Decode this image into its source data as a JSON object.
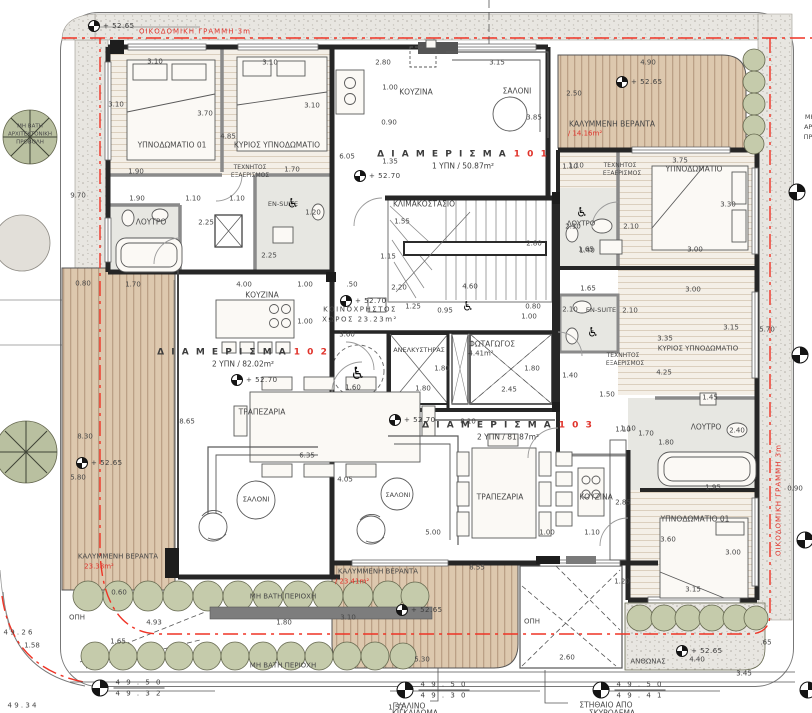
{
  "plan": {
    "colors": {
      "accent_red": "#e0322a",
      "wall": "#262626",
      "deck_wood": "#ddc8ae",
      "bush_green": "#c5cbab",
      "pavement": "#e8e6e1"
    },
    "apartments": [
      {
        "title": "Δ Ι Α Μ Ε Ρ Ι Σ Μ Α",
        "number": "1 0 1",
        "info": "1 ΥΠΝ / 50.87m²",
        "x": 463,
        "y": 160
      },
      {
        "title": "Δ Ι Α Μ Ε Ρ Ι Σ Μ Α",
        "number": "1 0 2",
        "info": "2 ΥΠΝ / 82.02m²",
        "x": 243,
        "y": 358
      },
      {
        "title": "Δ Ι Α Μ Ε Ρ Ι Σ Μ Α",
        "number": "1 0 3",
        "info": "2 ΥΠΝ / 81.87m²",
        "x": 508,
        "y": 431
      }
    ],
    "levels": [
      {
        "t": "+ 52.65",
        "x": 100,
        "y": 26
      },
      {
        "t": "+ 52.70",
        "x": 366,
        "y": 176
      },
      {
        "t": "+ 52.65",
        "x": 628,
        "y": 82
      },
      {
        "t": "+ 52.70",
        "x": 243,
        "y": 380
      },
      {
        "t": "+ 52.70",
        "x": 352,
        "y": 301
      },
      {
        "t": "+ 52.65",
        "x": 88,
        "y": 463
      },
      {
        "t": "+ 52.70",
        "x": 401,
        "y": 420
      },
      {
        "t": "+ 52.65",
        "x": 408,
        "y": 610
      },
      {
        "t": "+ 52.65",
        "x": 688,
        "y": 651
      }
    ],
    "spot_elevations": [
      {
        "top": "4 9 . 5 0",
        "bottom": "4 9 . 3 0",
        "x": 433,
        "y": 690
      },
      {
        "top": "4 9 . 5 0",
        "bottom": "4 9 . 4 1",
        "x": 629,
        "y": 690
      },
      {
        "top": "4 9 . 5 0",
        "bottom": "4 9 . 3 2",
        "x": 128,
        "y": 688
      },
      {
        "top": "",
        "bottom": "",
        "x": 797,
        "y": 192
      },
      {
        "top": "",
        "bottom": "",
        "x": 800,
        "y": 355
      },
      {
        "top": "",
        "bottom": "",
        "x": 805,
        "y": 540
      },
      {
        "top": "",
        "bottom": "",
        "x": 808,
        "y": 690
      }
    ],
    "symbols": {
      "wheelchair_glyph": "♿",
      "wheelchair_positions": [
        {
          "x": 293,
          "y": 204
        },
        {
          "x": 582,
          "y": 213
        },
        {
          "x": 468,
          "y": 307
        },
        {
          "x": 358,
          "y": 374,
          "s": 17
        },
        {
          "x": 593,
          "y": 333
        }
      ]
    },
    "labels": [
      {
        "t": "ΥΠΝΟΔΩΜΑΤΙΟ 01",
        "x": 172,
        "y": 145,
        "s": 7.5,
        "n": "room-label-bedroom01"
      },
      {
        "t": "ΚΥΡΙΟΣ ΥΠΝΟΔΩΜΑΤΙΟ",
        "x": 277,
        "y": 145,
        "s": 7.5,
        "n": "room-label-master-bedroom"
      },
      {
        "t": "ΛΟΥΤΡΟ",
        "x": 151,
        "y": 222,
        "s": 7.5,
        "n": "room-label-bathroom"
      },
      {
        "t": "EN-SUITE",
        "x": 283,
        "y": 204,
        "s": 6.5,
        "n": "room-label-ensuite"
      },
      {
        "t": "ΤΕΧΝΗΤΟΣ",
        "x": 250,
        "y": 168,
        "s": 6
      },
      {
        "t": "ΕΞΑΕΡΙΣΜΟΣ",
        "x": 250,
        "y": 176,
        "s": 6
      },
      {
        "t": "ΚΟΥΖΙΝΑ",
        "x": 416,
        "y": 92,
        "s": 7.5,
        "n": "room-label-kitchen"
      },
      {
        "t": "ΣΑΛΟΝΙ",
        "x": 517,
        "y": 91,
        "s": 7.5,
        "n": "room-label-living"
      },
      {
        "t": "ΚΑΛΥΜΜΕΝΗ ΒΕΡΑΝΤΑ",
        "x": 612,
        "y": 124,
        "s": 7.5,
        "n": "veranda-label"
      },
      {
        "t": "/ 14.16m²",
        "x": 585,
        "y": 134,
        "s": 7,
        "c": "r"
      },
      {
        "t": "ΥΠΝΟΔΩΜΑΤΙΟ",
        "x": 694,
        "y": 169,
        "s": 7.5
      },
      {
        "t": "ΤΕΧΝΗΤΟΣ",
        "x": 620,
        "y": 166,
        "s": 6
      },
      {
        "t": "ΕΞΑΕΡΙΣΜΟΣ",
        "x": 622,
        "y": 174,
        "s": 6
      },
      {
        "t": "ΛΟΥΤΡΟ",
        "x": 581,
        "y": 224,
        "s": 7
      },
      {
        "t": "ΚΛΙΜΑΚΟΣΤΑΣΙΟ",
        "x": 424,
        "y": 204,
        "s": 7.5,
        "n": "room-label-stairwell"
      },
      {
        "t": "ΚΟΙΝΟΧΡΗΣΤΟΣ",
        "x": 360,
        "y": 310,
        "s": 7,
        "sp": 1.5
      },
      {
        "t": "ΧΩΡΟΣ 23.23m²",
        "x": 360,
        "y": 320,
        "s": 7,
        "sp": 1.5
      },
      {
        "t": "ΑΝΕΛΚΥΣΤΗΡΑΣ",
        "x": 419,
        "y": 350,
        "s": 6.5,
        "n": "room-label-elevator"
      },
      {
        "t": "ΦΩΤΑΓΩΓΟΣ",
        "x": 492,
        "y": 344,
        "s": 7.5,
        "n": "room-label-lightwell"
      },
      {
        "t": "4.41m²",
        "x": 481,
        "y": 354,
        "s": 7
      },
      {
        "t": "EN-SUITE",
        "x": 601,
        "y": 310,
        "s": 6.5
      },
      {
        "t": "ΚΥΡΙΟΣ ΥΠΝΟΔΩΜΑΤΙΟ",
        "x": 698,
        "y": 349,
        "s": 7
      },
      {
        "t": "ΤΕΧΝΗΤΟΣ",
        "x": 623,
        "y": 356,
        "s": 6
      },
      {
        "t": "ΕΞΑΕΡΙΣΜΟΣ",
        "x": 625,
        "y": 364,
        "s": 6
      },
      {
        "t": "ΛΟΥΤΡΟ",
        "x": 706,
        "y": 427,
        "s": 7.5
      },
      {
        "t": "ΚΟΥΖΙΝΑ",
        "x": 262,
        "y": 295,
        "s": 7.5
      },
      {
        "t": "ΤΡΑΠΕΖΑΡΙΑ",
        "x": 262,
        "y": 412,
        "s": 7.5,
        "n": "room-label-dining"
      },
      {
        "t": "ΣΑΛΟΝΙ",
        "x": 256,
        "y": 500,
        "s": 7
      },
      {
        "t": "ΚΑΛΥΜΜΕΝΗ ΒΕΡΑΝΤΑ",
        "x": 118,
        "y": 557,
        "s": 7
      },
      {
        "t": "23.38m²",
        "x": 99,
        "y": 567,
        "s": 7,
        "c": "r"
      },
      {
        "t": "ΣΑΛΟΝΙ",
        "x": 398,
        "y": 495,
        "s": 6.5
      },
      {
        "t": "ΤΡΑΠΕΖΑΡΙΑ",
        "x": 500,
        "y": 497,
        "s": 7.5
      },
      {
        "t": "ΚΟΥΖΙΝΑ",
        "x": 596,
        "y": 497,
        "s": 7.5
      },
      {
        "t": "ΥΠΝΟΔΩΜΑΤΙΟ 01",
        "x": 695,
        "y": 519,
        "s": 7.5
      },
      {
        "t": "ΚΑΛΥΜΜΕΝΗ ΒΕΡΑΝΤΑ",
        "x": 378,
        "y": 572,
        "s": 7
      },
      {
        "t": "/ 23.41m²",
        "x": 352,
        "y": 582,
        "s": 7,
        "c": "r"
      },
      {
        "t": "ΜΗ ΒΑΤΗ ΠΕΡΙΟΧΗ",
        "x": 283,
        "y": 597,
        "s": 7,
        "n": "note-non-walkable"
      },
      {
        "t": "ΜΗ ΒΑΤΗ ΠΕΡΙΟΧΗ",
        "x": 283,
        "y": 666,
        "s": 7,
        "n": "note-non-walkable"
      },
      {
        "t": "ΑΝΘΩΝΑΣ",
        "x": 648,
        "y": 662,
        "s": 7,
        "n": "note-planter"
      },
      {
        "t": "ΟΠΗ",
        "x": 77,
        "y": 618,
        "s": 7
      },
      {
        "t": "ΟΠΗ",
        "x": 532,
        "y": 622,
        "s": 7
      },
      {
        "t": "ΓΥΑΛΙΝΟ",
        "x": 409,
        "y": 706,
        "s": 7.5,
        "n": "note-glass"
      },
      {
        "t": "ΚΙΓΚΛΙΔΩΜΑ",
        "x": 415,
        "y": 713,
        "s": 7.5
      },
      {
        "t": "ΣΤΗΘΑΙΟ ΑΠΟ",
        "x": 606,
        "y": 705,
        "s": 7.5,
        "n": "note-parapet"
      },
      {
        "t": "ΣΚΥΡΟΔΕΜΑ",
        "x": 612,
        "y": 713,
        "s": 7.5
      },
      {
        "t": "ΟΙΚΟΔΟΜΙΚΗ ΓΡΑΜΜΗ 3m",
        "x": 195,
        "y": 32,
        "s": 7,
        "c": "r",
        "sp": 1,
        "n": "note-building-line"
      },
      {
        "t": "ΟΙΚΟΔΟΜΙΚΗ ΓΡΑΜΜΗ 3m",
        "x": 779,
        "y": 500,
        "s": 7,
        "c": "r",
        "sp": 1,
        "r": -90,
        "n": "note-building-line"
      },
      {
        "t": "ΜΗ ΒΑΤΗ",
        "x": 30,
        "y": 127,
        "s": 5.5
      },
      {
        "t": "ΑΡΧΙΤΕΚΤΟΝΙΚΗ",
        "x": 30,
        "y": 135,
        "s": 5.5
      },
      {
        "t": "ΠΡΟΒΟΛΗ",
        "x": 30,
        "y": 143,
        "s": 5.5
      },
      {
        "t": "ΜΗ ΒΑΤΗ",
        "x": 820,
        "y": 117,
        "s": 6.5
      },
      {
        "t": "ΑΡΧΙΤΕΚΤΟΝΙΚΗ",
        "x": 830,
        "y": 127,
        "s": 6.5
      },
      {
        "t": "ΠΡΟΒΟΛΗ",
        "x": 820,
        "y": 137,
        "s": 6.5
      },
      {
        "t": "3.10",
        "x": 155,
        "y": 62
      },
      {
        "t": "3.10",
        "x": 270,
        "y": 63
      },
      {
        "t": "3.10",
        "x": 116,
        "y": 105
      },
      {
        "t": "3.70",
        "x": 205,
        "y": 114
      },
      {
        "t": "3.10",
        "x": 312,
        "y": 106
      },
      {
        "t": "4.85",
        "x": 228,
        "y": 137
      },
      {
        "t": "1.90",
        "x": 136,
        "y": 172
      },
      {
        "t": "1.70",
        "x": 292,
        "y": 170
      },
      {
        "t": "1.90",
        "x": 137,
        "y": 199
      },
      {
        "t": "1.10",
        "x": 193,
        "y": 199
      },
      {
        "t": "1.10",
        "x": 237,
        "y": 199
      },
      {
        "t": "1.20",
        "x": 313,
        "y": 213
      },
      {
        "t": "2.25",
        "x": 206,
        "y": 223
      },
      {
        "t": "2.25",
        "x": 269,
        "y": 256
      },
      {
        "t": "2.80",
        "x": 383,
        "y": 63
      },
      {
        "t": "3.15",
        "x": 497,
        "y": 63
      },
      {
        "t": "1.00",
        "x": 390,
        "y": 88
      },
      {
        "t": "0.90",
        "x": 389,
        "y": 123
      },
      {
        "t": "3.85",
        "x": 534,
        "y": 118
      },
      {
        "t": "2.50",
        "x": 574,
        "y": 94
      },
      {
        "t": "6.05",
        "x": 347,
        "y": 157
      },
      {
        "t": "1.35",
        "x": 390,
        "y": 162
      },
      {
        "t": "1.10",
        "x": 576,
        "y": 166
      },
      {
        "t": "1.55",
        "x": 402,
        "y": 222
      },
      {
        "t": "2.80",
        "x": 534,
        "y": 244
      },
      {
        "t": "1.15",
        "x": 388,
        "y": 257
      },
      {
        "t": "4.90",
        "x": 648,
        "y": 63
      },
      {
        "t": "3.75",
        "x": 680,
        "y": 161
      },
      {
        "t": "3.30",
        "x": 728,
        "y": 205
      },
      {
        "t": "2.10",
        "x": 573,
        "y": 227
      },
      {
        "t": "2.10",
        "x": 631,
        "y": 227
      },
      {
        "t": "1.65",
        "x": 586,
        "y": 250
      },
      {
        "t": "3.00",
        "x": 695,
        "y": 250
      },
      {
        "t": "1.10",
        "x": 570,
        "y": 167
      },
      {
        "t": "4.00",
        "x": 244,
        "y": 285
      },
      {
        "t": "1.00",
        "x": 305,
        "y": 285
      },
      {
        "t": ".50",
        "x": 352,
        "y": 285
      },
      {
        "t": "2.20",
        "x": 399,
        "y": 288
      },
      {
        "t": "4.60",
        "x": 470,
        "y": 287
      },
      {
        "t": "1.00",
        "x": 305,
        "y": 322
      },
      {
        "t": "3.60",
        "x": 347,
        "y": 335
      },
      {
        "t": "1.60",
        "x": 353,
        "y": 388
      },
      {
        "t": "8.65",
        "x": 187,
        "y": 422
      },
      {
        "t": "8.30",
        "x": 85,
        "y": 437
      },
      {
        "t": "6.35",
        "x": 307,
        "y": 456
      },
      {
        "t": "1.25",
        "x": 413,
        "y": 307
      },
      {
        "t": "0.95",
        "x": 445,
        "y": 311
      },
      {
        "t": "0.80",
        "x": 533,
        "y": 307
      },
      {
        "t": "1.00",
        "x": 529,
        "y": 317
      },
      {
        "t": "1.80",
        "x": 442,
        "y": 369
      },
      {
        "t": "1.80",
        "x": 532,
        "y": 369
      },
      {
        "t": "1.80",
        "x": 423,
        "y": 389
      },
      {
        "t": "2.45",
        "x": 509,
        "y": 390
      },
      {
        "t": "1.40",
        "x": 570,
        "y": 376
      },
      {
        "t": "1.40",
        "x": 587,
        "y": 251
      },
      {
        "t": "1.65",
        "x": 588,
        "y": 289
      },
      {
        "t": "2.10",
        "x": 570,
        "y": 310
      },
      {
        "t": "2.10",
        "x": 630,
        "y": 311
      },
      {
        "t": "3.00",
        "x": 693,
        "y": 290
      },
      {
        "t": "3.35",
        "x": 665,
        "y": 339
      },
      {
        "t": "3.15",
        "x": 731,
        "y": 328
      },
      {
        "t": "5.70",
        "x": 767,
        "y": 330
      },
      {
        "t": "4.25",
        "x": 664,
        "y": 373
      },
      {
        "t": "1.50",
        "x": 607,
        "y": 395
      },
      {
        "t": "1.10",
        "x": 628,
        "y": 429
      },
      {
        "t": "1.70",
        "x": 646,
        "y": 434
      },
      {
        "t": "1.80",
        "x": 666,
        "y": 443
      },
      {
        "t": "2.40",
        "x": 737,
        "y": 431
      },
      {
        "t": "1.45",
        "x": 710,
        "y": 398
      },
      {
        "t": "1.95",
        "x": 713,
        "y": 488
      },
      {
        "t": "0.90",
        "x": 795,
        "y": 489
      },
      {
        "t": "2.85",
        "x": 623,
        "y": 503
      },
      {
        "t": "3.60",
        "x": 668,
        "y": 540
      },
      {
        "t": "3.00",
        "x": 733,
        "y": 553
      },
      {
        "t": "3.15",
        "x": 693,
        "y": 590
      },
      {
        "t": "1.20",
        "x": 622,
        "y": 582
      },
      {
        "t": "5.80",
        "x": 78,
        "y": 478
      },
      {
        "t": "0.60",
        "x": 119,
        "y": 593
      },
      {
        "t": "4.93",
        "x": 154,
        "y": 623
      },
      {
        "t": "1.80",
        "x": 284,
        "y": 623
      },
      {
        "t": "3.10",
        "x": 348,
        "y": 618
      },
      {
        "t": "5.30",
        "x": 422,
        "y": 660
      },
      {
        "t": "2.60",
        "x": 567,
        "y": 658
      },
      {
        "t": "1.57",
        "x": 396,
        "y": 708
      },
      {
        "t": "8.10",
        "x": 468,
        "y": 422
      },
      {
        "t": "4.05",
        "x": 345,
        "y": 480
      },
      {
        "t": "5.00",
        "x": 433,
        "y": 533
      },
      {
        "t": "1.00",
        "x": 547,
        "y": 533
      },
      {
        "t": "1.10",
        "x": 592,
        "y": 533
      },
      {
        "t": "1.10",
        "x": 623,
        "y": 430
      },
      {
        "t": "8.55",
        "x": 477,
        "y": 568
      },
      {
        "t": "4.40",
        "x": 697,
        "y": 660
      },
      {
        "t": "3.45",
        "x": 744,
        "y": 674
      },
      {
        "t": ".65",
        "x": 766,
        "y": 643
      },
      {
        "t": "1.58",
        "x": 32,
        "y": 646
      },
      {
        "t": "1.65",
        "x": 118,
        "y": 642
      },
      {
        "t": "0.80",
        "x": 83,
        "y": 284
      },
      {
        "t": "1.70",
        "x": 133,
        "y": 285
      },
      {
        "t": "9.70",
        "x": 78,
        "y": 196
      },
      {
        "t": "4 9 . 2 6",
        "x": 18,
        "y": 633
      },
      {
        "t": "4 9 . 3 4",
        "x": 22,
        "y": 706
      }
    ]
  }
}
